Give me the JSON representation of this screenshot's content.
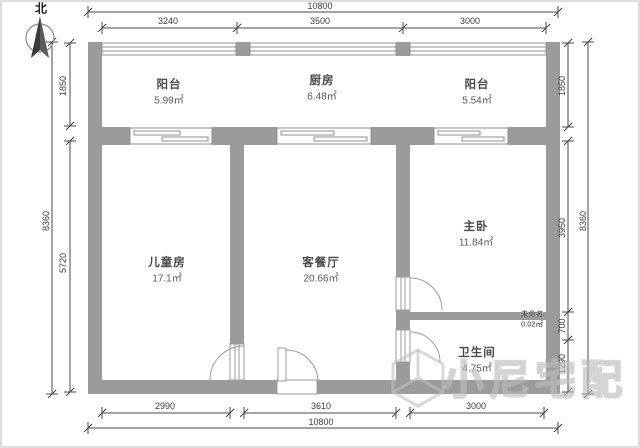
{
  "page": {
    "type": "apartment-floor-plan"
  },
  "compass": {
    "label": "北"
  },
  "rooms": [
    {
      "name": "阳台",
      "area": "5.99㎡"
    },
    {
      "name": "厨房",
      "area": "6.48㎡"
    },
    {
      "name": "阳台",
      "area": "5.54㎡"
    },
    {
      "name": "儿童房",
      "area": "17.1㎡"
    },
    {
      "name": "客餐厅",
      "area": "20.66㎡"
    },
    {
      "name": "主卧",
      "area": "11.84㎡"
    },
    {
      "name": "卫生间",
      "area": "4.75㎡"
    },
    {
      "name": "未命名",
      "area": "0.02㎡"
    }
  ],
  "dimensions": {
    "top": {
      "overall": "10800",
      "segments": [
        "3240",
        "3500",
        "3000"
      ]
    },
    "bottom": {
      "overall": "10800",
      "segments": [
        "2990",
        "3610",
        "3000"
      ]
    },
    "left": {
      "overall": "8360",
      "segments": [
        "1850",
        "5720"
      ]
    },
    "right": {
      "overall": "8360",
      "segments": [
        "1850",
        "3950",
        "700",
        "1290"
      ]
    }
  },
  "watermark": {
    "text": "小尼宅配"
  },
  "colors": {
    "wall": "#9b9b9b",
    "dimension_line": "#4a4a4a",
    "room_text": "#4a4a4a",
    "watermark": "#c3c3c3"
  }
}
